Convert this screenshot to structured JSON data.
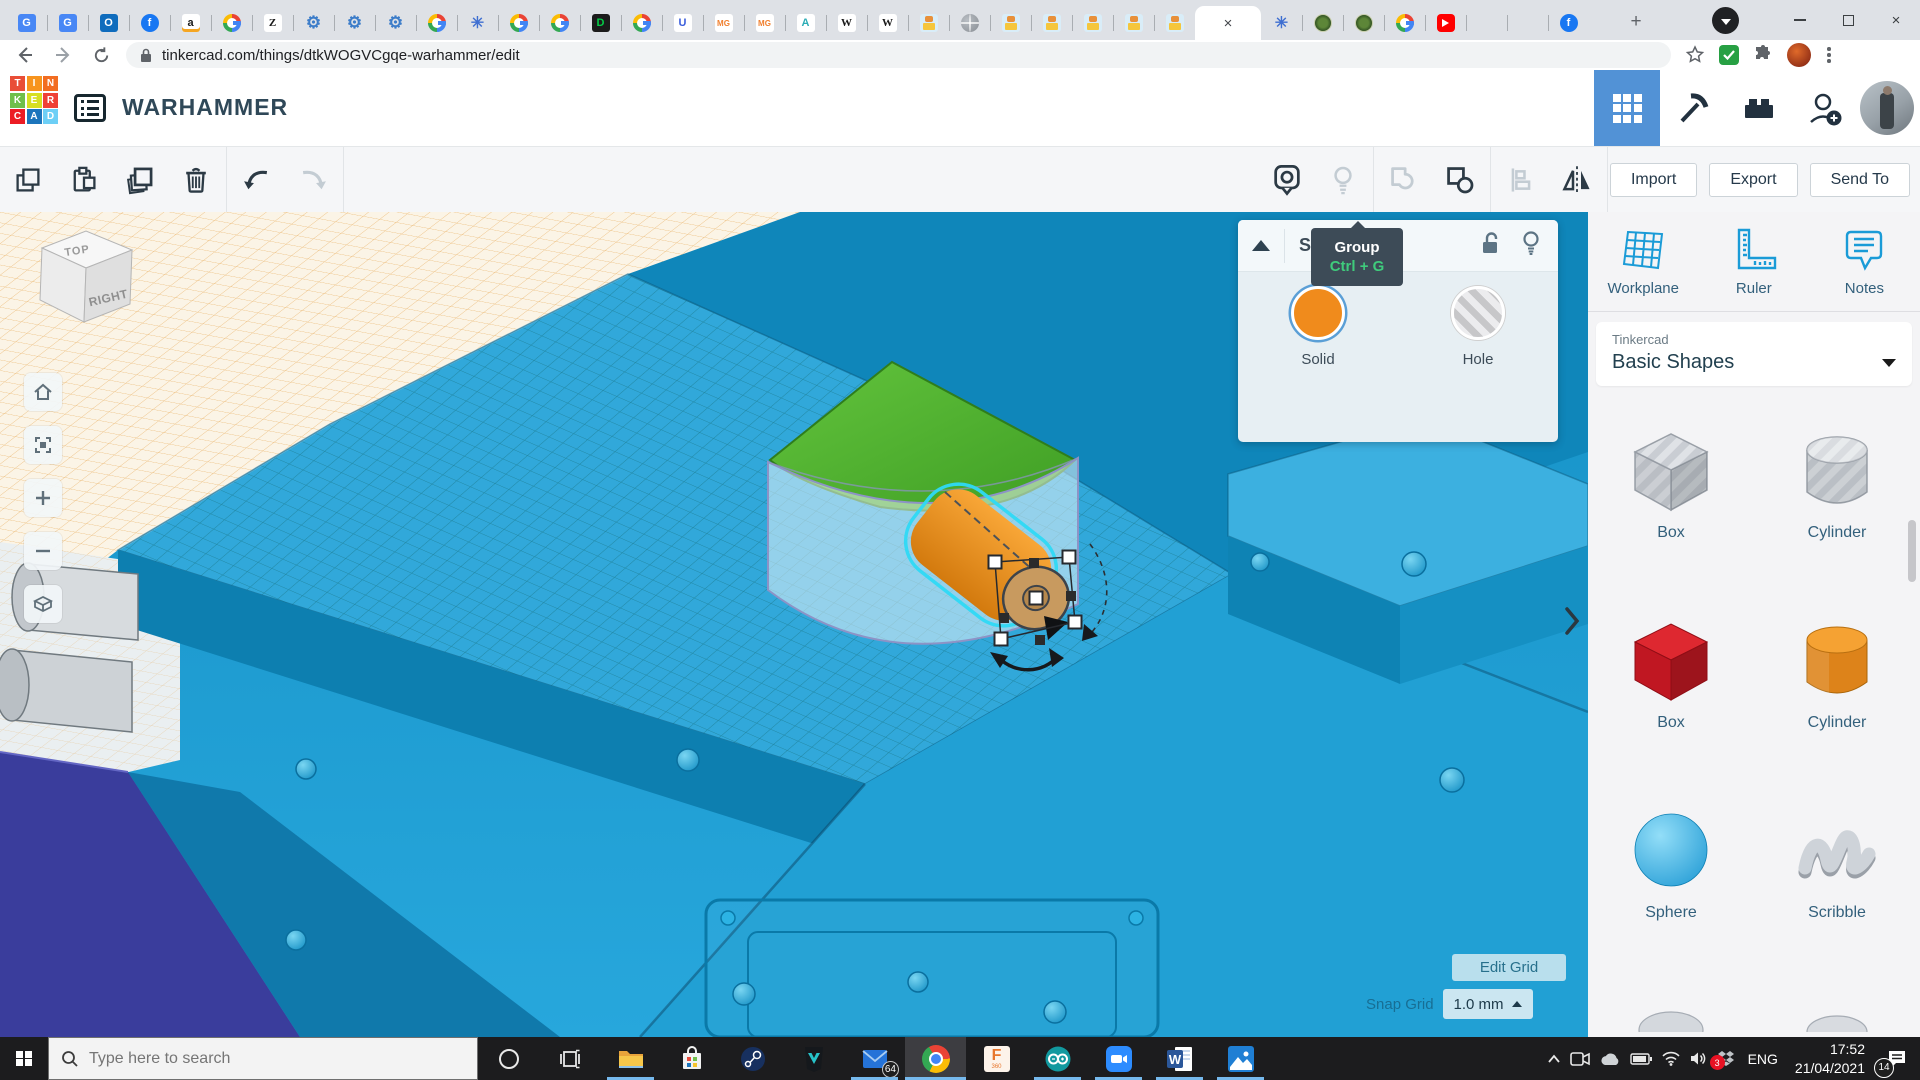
{
  "browser": {
    "url": "tinkercad.com/things/dtkWOGVCgqe-warhammer/edit",
    "tabs": [
      {
        "icon": "google-translate"
      },
      {
        "icon": "google-translate"
      },
      {
        "icon": "outlook"
      },
      {
        "icon": "facebook"
      },
      {
        "icon": "amazon"
      },
      {
        "icon": "google"
      },
      {
        "icon": "zalando"
      },
      {
        "icon": "gear"
      },
      {
        "icon": "gear"
      },
      {
        "icon": "gear"
      },
      {
        "icon": "google"
      },
      {
        "icon": "flower"
      },
      {
        "icon": "google"
      },
      {
        "icon": "google"
      },
      {
        "icon": "deviantart"
      },
      {
        "icon": "google"
      },
      {
        "icon": "udemy"
      },
      {
        "icon": "mg"
      },
      {
        "icon": "mg"
      },
      {
        "icon": "autodesk"
      },
      {
        "icon": "wikipedia"
      },
      {
        "icon": "wikipedia"
      },
      {
        "icon": "robot"
      },
      {
        "icon": "globe"
      },
      {
        "icon": "robot"
      },
      {
        "icon": "robot"
      },
      {
        "icon": "robot"
      },
      {
        "icon": "robot"
      },
      {
        "icon": "robot"
      },
      {
        "icon": "active"
      },
      {
        "icon": "flower"
      },
      {
        "icon": "emblem"
      },
      {
        "icon": "emblem"
      },
      {
        "icon": "google"
      },
      {
        "icon": "youtube"
      },
      {
        "icon": "tinkercad"
      },
      {
        "icon": "microsoft"
      },
      {
        "icon": "facebook"
      }
    ]
  },
  "header": {
    "title": "WARHAMMER",
    "logo_letters": [
      "T",
      "I",
      "N",
      "K",
      "E",
      "R",
      "C",
      "A",
      "D"
    ],
    "icons": [
      "dashboard-grid",
      "minecraft-pickaxe",
      "lego-brick",
      "invite-user",
      "avatar"
    ]
  },
  "toolbar": {
    "left_icons": [
      "copy",
      "paste",
      "duplicate",
      "delete",
      "undo",
      "redo"
    ],
    "right_icons": [
      "show-all",
      "lightbulb",
      "group",
      "ungroup",
      "align",
      "mirror"
    ],
    "import_label": "Import",
    "export_label": "Export",
    "send_to_label": "Send To"
  },
  "tooltip": {
    "title": "Group",
    "shortcut": "Ctrl + G"
  },
  "inspector": {
    "title": "Shape",
    "icons": [
      "collapse",
      "unlock",
      "lightbulb"
    ],
    "solid_label": "Solid",
    "hole_label": "Hole"
  },
  "canvas": {
    "viewcube_top": "TOP",
    "viewcube_right": "RIGHT",
    "tools": [
      "home-view",
      "fit-view",
      "zoom-in",
      "zoom-out",
      "perspective"
    ],
    "edit_grid_label": "Edit Grid",
    "snap_grid_label": "Snap Grid",
    "snap_grid_value": "1.0 mm"
  },
  "sidebar": {
    "tools": [
      {
        "label": "Workplane"
      },
      {
        "label": "Ruler"
      },
      {
        "label": "Notes"
      }
    ],
    "library_brand": "Tinkercad",
    "library_value": "Basic Shapes",
    "shapes": [
      {
        "label": "Box",
        "variant": "hole-box"
      },
      {
        "label": "Cylinder",
        "variant": "hole-cylinder"
      },
      {
        "label": "Box",
        "variant": "solid-box"
      },
      {
        "label": "Cylinder",
        "variant": "solid-cylinder"
      },
      {
        "label": "Sphere",
        "variant": "sphere"
      },
      {
        "label": "Scribble",
        "variant": "scribble"
      }
    ]
  },
  "taskbar": {
    "search_placeholder": "Type here to search",
    "icons": [
      "start",
      "cortana",
      "task-view",
      "file-explorer",
      "microsoft-store",
      "steam",
      "predator",
      "mail",
      "chrome",
      "fusion-360",
      "arduino",
      "zoom",
      "word",
      "photos"
    ],
    "tray_icons": [
      "chevron-up",
      "meet-now",
      "onedrive",
      "battery",
      "wifi",
      "volume",
      "dropbox",
      "notifications"
    ],
    "mail_badge": "64",
    "dropbox_badge": "3",
    "notification_badge": "14",
    "language": "ENG",
    "time": "17:52",
    "date": "21/04/2021"
  },
  "colors": {
    "accent_blue": "#1a9bd7",
    "solid_orange": "#f08b1c",
    "selection_cyan": "#2ed9f6",
    "tooltip_bg": "#3d4b57",
    "tooltip_shortcut_green": "#3fcb7c",
    "taskbar_underline": "#76b9ed",
    "logo_tiles": [
      "#e94e37",
      "#f7941e",
      "#f26d21",
      "#70bf4b",
      "#d7df23",
      "#ef4136",
      "#ec1c24",
      "#1c75bc",
      "#6dcff6"
    ]
  }
}
